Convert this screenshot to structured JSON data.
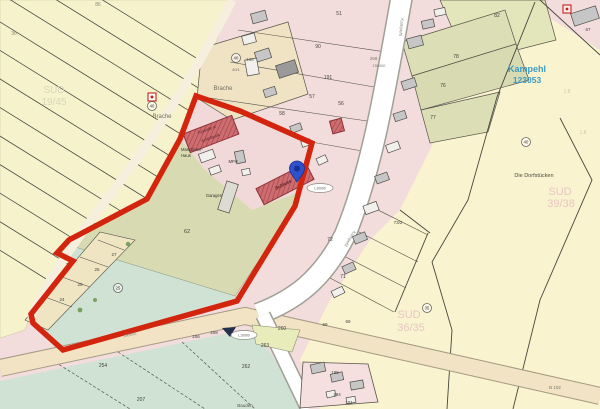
{
  "map": {
    "place": {
      "name": "Kampehl",
      "id": "123053"
    },
    "colors": {
      "boundary_red": "#d3250e",
      "pin_blue": "#2e52cc",
      "place_label_blue": "#3d9ac2",
      "watermark_pink": "#e6c6c4",
      "watermark_gray": "#d6d6bc"
    },
    "labels": [
      {
        "t": "Brache",
        "x": 223,
        "y": 90,
        "s": 6,
        "c": "#6f6f5e"
      },
      {
        "t": "Brache",
        "x": 162,
        "y": 118,
        "s": 6,
        "c": "#6f6f5e"
      },
      {
        "t": "Die Dorfstücken",
        "x": 534,
        "y": 177,
        "s": 5.5,
        "c": "#4a4a42"
      },
      {
        "t": "SUD",
        "x": 560,
        "y": 195,
        "s": 11,
        "c": "#e6c6c4"
      },
      {
        "t": "39/38",
        "x": 561,
        "y": 207,
        "s": 11,
        "c": "#e6c6c4"
      },
      {
        "t": "SUD",
        "x": 409,
        "y": 318,
        "s": 11,
        "c": "#e6c6c4"
      },
      {
        "t": "36/35",
        "x": 411,
        "y": 331,
        "s": 11,
        "c": "#e6c6c4"
      },
      {
        "t": "SUD",
        "x": 54,
        "y": 93,
        "s": 10,
        "c": "#d6d6bc"
      },
      {
        "t": "19/45",
        "x": 54,
        "y": 105,
        "s": 10,
        "c": "#d6d6bc"
      },
      {
        "t": "62",
        "x": 187,
        "y": 233,
        "s": 5.5
      },
      {
        "t": "82",
        "x": 497,
        "y": 17,
        "s": 5
      },
      {
        "t": "78",
        "x": 456,
        "y": 58,
        "s": 5
      },
      {
        "t": "76",
        "x": 443,
        "y": 87,
        "s": 5
      },
      {
        "t": "77",
        "x": 433,
        "y": 119,
        "s": 5
      },
      {
        "t": "191",
        "x": 328,
        "y": 79,
        "s": 5
      },
      {
        "t": "57",
        "x": 312,
        "y": 98,
        "s": 5
      },
      {
        "t": "56",
        "x": 341,
        "y": 105,
        "s": 5
      },
      {
        "t": "58",
        "x": 282,
        "y": 115,
        "s": 5
      },
      {
        "t": "51",
        "x": 339,
        "y": 15,
        "s": 5
      },
      {
        "t": "90",
        "x": 318,
        "y": 48,
        "s": 5
      },
      {
        "t": "73/2",
        "x": 398,
        "y": 224,
        "s": 4.5
      },
      {
        "t": "72",
        "x": 330,
        "y": 241,
        "s": 5
      },
      {
        "t": "71",
        "x": 343,
        "y": 278,
        "s": 5
      },
      {
        "t": "68",
        "x": 325,
        "y": 326,
        "s": 4.5
      },
      {
        "t": "69",
        "x": 348,
        "y": 323,
        "s": 4.5
      },
      {
        "t": "195",
        "x": 335,
        "y": 374,
        "s": 4.5
      },
      {
        "t": "194",
        "x": 337,
        "y": 396,
        "s": 4.5
      },
      {
        "t": "101",
        "x": 349,
        "y": 404,
        "s": 4.5
      },
      {
        "t": "263",
        "x": 265,
        "y": 347,
        "s": 5
      },
      {
        "t": "262",
        "x": 246,
        "y": 368,
        "s": 5
      },
      {
        "t": "260",
        "x": 282,
        "y": 330,
        "s": 5
      },
      {
        "t": "254",
        "x": 103,
        "y": 367,
        "s": 5
      },
      {
        "t": "207",
        "x": 141,
        "y": 401,
        "s": 5
      },
      {
        "t": "206",
        "x": 196,
        "y": 338,
        "s": 4.5
      },
      {
        "t": "208",
        "x": 214,
        "y": 334,
        "s": 4.5
      },
      {
        "t": "24",
        "x": 62,
        "y": 301,
        "s": 4.5
      },
      {
        "t": "25",
        "x": 80,
        "y": 286,
        "s": 4.5
      },
      {
        "t": "26",
        "x": 97,
        "y": 271,
        "s": 4.5
      },
      {
        "t": "27",
        "x": 114,
        "y": 256,
        "s": 4.5
      },
      {
        "t": "36",
        "x": 14,
        "y": 35,
        "s": 5,
        "c": "#8a8a76"
      },
      {
        "t": "86",
        "x": 98,
        "y": 6,
        "s": 5,
        "c": "#8a8a76"
      },
      {
        "t": "158",
        "x": 250,
        "y": 61,
        "s": 4.5,
        "c": "#6a6a60"
      },
      {
        "t": "40/1",
        "x": 236,
        "y": 71,
        "s": 4,
        "c": "#6a6a60"
      },
      {
        "t": "67",
        "x": 588,
        "y": 31,
        "s": 4.5
      },
      {
        "t": "1.8",
        "x": 567,
        "y": 93,
        "s": 5,
        "c": "#cfc9ab"
      },
      {
        "t": "1.8",
        "x": 583,
        "y": 134,
        "s": 5,
        "c": "#cfc9ab"
      },
      {
        "t": "B 102",
        "x": 555,
        "y": 389,
        "s": 4.5,
        "c": "#77776b"
      },
      {
        "t": "Bauden",
        "x": 245,
        "y": 407,
        "s": 4.5,
        "c": "#55554b"
      },
      {
        "t": "Maschinen-",
        "x": 181,
        "y": 151,
        "s": 4.2,
        "c": "#33332d",
        "a": "start"
      },
      {
        "t": "Haus",
        "x": 181,
        "y": 157,
        "s": 4.2,
        "c": "#33332d",
        "a": "start"
      },
      {
        "t": "MFH",
        "x": 233,
        "y": 163,
        "s": 4.2,
        "c": "#33332d"
      },
      {
        "t": "Garagen",
        "x": 214,
        "y": 197,
        "s": 4.2,
        "c": "#33332d"
      },
      {
        "t": "Schloss",
        "x": 284,
        "y": 186,
        "s": 4.6,
        "c": "#4d1d20",
        "r": -27,
        "b": true
      },
      {
        "t": "Turnhalle &",
        "x": 207,
        "y": 131,
        "s": 3.8,
        "c": "#4d1d20",
        "r": -21
      },
      {
        "t": "Schloßpark",
        "x": 211,
        "y": 139,
        "s": 3.8,
        "c": "#4d1d20",
        "r": -21
      },
      {
        "t": "268 -",
        "x": 375,
        "y": 60,
        "s": 4.5,
        "c": "#77776b"
      },
      {
        "t": "150000",
        "x": 379,
        "y": 67,
        "s": 3.8,
        "c": "#77776b"
      },
      {
        "t": "Kampehl",
        "x": 400,
        "y": 27,
        "s": 4.5,
        "c": "#8a8a80",
        "r": 96
      },
      {
        "t": "Kampehl",
        "x": 349,
        "y": 238,
        "s": 4.5,
        "c": "#8a8a80",
        "r": 122
      },
      {
        "t": "150000",
        "x": 130,
        "y": 336,
        "s": 4,
        "c": "#8a8a80",
        "r": -12
      }
    ],
    "circled_markers": [
      {
        "t": "40",
        "x": 236,
        "y": 58
      },
      {
        "t": "40",
        "x": 152,
        "y": 106
      },
      {
        "t": "40",
        "x": 526,
        "y": 142
      },
      {
        "t": "35",
        "x": 427,
        "y": 308
      },
      {
        "t": "25",
        "x": 118,
        "y": 288
      }
    ],
    "road_badges": [
      {
        "t": "L10000",
        "x": 320,
        "y": 188
      },
      {
        "t": "L10000",
        "x": 244,
        "y": 335
      }
    ]
  }
}
